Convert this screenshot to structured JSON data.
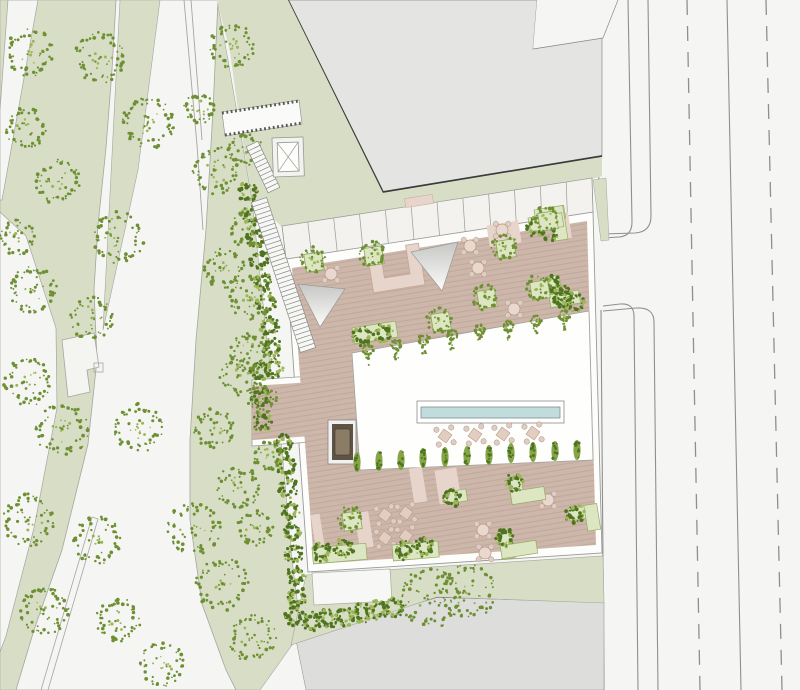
{
  "meta": {
    "title": "architectural-site-plan",
    "width": 800,
    "height": 690
  },
  "colors": {
    "bg": "#f5f5f3",
    "park_green": "#d7dec5",
    "path_stroke": "#a5a5a1",
    "tree_dark": "#5f8125",
    "tree_mid": "#6e9033",
    "tree_light": "#9cb657",
    "hedge_dark": "#4f7321",
    "hedge_light": "#9cb657",
    "building_fill": "#e4e4e2",
    "building_stroke": "#8a8a86",
    "building_dark_edge": "#3b3b39",
    "south_building_fill": "#dddddb",
    "south_building_edge": "#55534f",
    "road_line": "#8f8f8d",
    "site_border": "#9a9a96",
    "deck": "#cdb7aa",
    "deck_stripe": "#c1a99c",
    "parking_fill": "#f3f2ef",
    "courtyard_fill": "#fefefd",
    "white_patch": "#f7f7f5",
    "pink": "#e7d5cc",
    "pink_stroke": "#c5a795",
    "table_fill": "#ead8cf",
    "chair_fill": "#dfccc2",
    "chair_stroke": "#b59a89",
    "planter_green": "#dde6c2",
    "planter_stroke": "#97aa62",
    "pool_blue": "#c2dcde",
    "pool_stroke": "#7e8f91",
    "spa_dark": "#5d5446",
    "spa_mid": "#8b7d65",
    "tri_from": "#c6c6c4",
    "tri_to": "#fcfcfb",
    "stair_line": "#8a8a86",
    "hatch_dark": "#555553",
    "cypress_fill": "#85a546"
  },
  "park": {
    "base": [
      [
        0,
        0
      ],
      [
        217,
        0
      ],
      [
        228,
        60
      ],
      [
        252,
        200
      ],
      [
        268,
        350
      ],
      [
        282,
        450
      ],
      [
        292,
        560
      ],
      [
        300,
        622
      ],
      [
        292,
        645
      ],
      [
        260,
        690
      ],
      [
        0,
        690
      ]
    ],
    "path_a": [
      [
        8,
        0
      ],
      [
        38,
        0
      ],
      [
        2,
        200
      ],
      [
        0,
        200
      ],
      [
        0,
        110
      ]
    ],
    "path_b": [
      [
        0,
        212
      ],
      [
        26,
        236
      ],
      [
        56,
        328
      ],
      [
        57,
        408
      ],
      [
        34,
        528
      ],
      [
        6,
        636
      ],
      [
        0,
        652
      ]
    ],
    "path_big": [
      [
        116,
        0
      ],
      [
        218,
        0
      ],
      [
        213,
        110
      ],
      [
        206,
        230
      ],
      [
        196,
        340
      ],
      [
        190,
        440
      ],
      [
        190,
        520
      ],
      [
        202,
        604
      ],
      [
        226,
        670
      ],
      [
        236,
        690
      ],
      [
        16,
        690
      ],
      [
        34,
        630
      ],
      [
        62,
        550
      ],
      [
        88,
        444
      ],
      [
        97,
        360
      ],
      [
        94,
        290
      ],
      [
        98,
        225
      ],
      [
        106,
        148
      ],
      [
        112,
        70
      ]
    ],
    "green_island": [
      [
        120,
        0
      ],
      [
        160,
        0
      ],
      [
        138,
        170
      ],
      [
        103,
        330
      ]
    ],
    "wall_lines": [
      [
        [
          184,
          0
        ],
        [
          197,
          145
        ],
        [
          203,
          230
        ]
      ],
      [
        [
          191,
          0
        ],
        [
          202,
          140
        ]
      ]
    ],
    "ramp_wall": [
      [
        92,
        517
      ],
      [
        98,
        519
      ],
      [
        48,
        690
      ],
      [
        41,
        690
      ]
    ],
    "kiosk": [
      [
        62,
        340
      ],
      [
        94,
        333
      ],
      [
        99,
        367
      ],
      [
        87,
        370
      ],
      [
        90,
        392
      ],
      [
        68,
        397
      ]
    ],
    "kiosk_square": [
      94,
      363,
      9,
      9
    ],
    "trees": [
      [
        30,
        52,
        24
      ],
      [
        100,
        57,
        26
      ],
      [
        232,
        46,
        22
      ],
      [
        26,
        128,
        20
      ],
      [
        148,
        122,
        27
      ],
      [
        58,
        182,
        22
      ],
      [
        216,
        170,
        24
      ],
      [
        200,
        108,
        16
      ],
      [
        246,
        150,
        17
      ],
      [
        18,
        238,
        18
      ],
      [
        118,
        238,
        26
      ],
      [
        34,
        290,
        24
      ],
      [
        92,
        318,
        22
      ],
      [
        252,
        298,
        22
      ],
      [
        224,
        268,
        20
      ],
      [
        250,
        228,
        20
      ],
      [
        28,
        382,
        24
      ],
      [
        250,
        352,
        20
      ],
      [
        262,
        398,
        15
      ],
      [
        62,
        430,
        26
      ],
      [
        138,
        428,
        24
      ],
      [
        214,
        428,
        20
      ],
      [
        240,
        375,
        20
      ],
      [
        268,
        455,
        15
      ],
      [
        28,
        520,
        26
      ],
      [
        98,
        540,
        24
      ],
      [
        194,
        528,
        26
      ],
      [
        238,
        488,
        22
      ],
      [
        255,
        528,
        18
      ],
      [
        222,
        584,
        26
      ],
      [
        44,
        610,
        24
      ],
      [
        118,
        620,
        22
      ],
      [
        252,
        638,
        24
      ],
      [
        162,
        664,
        22
      ],
      [
        430,
        598,
        30
      ],
      [
        468,
        592,
        27
      ]
    ]
  },
  "buildings": {
    "north_body": [
      [
        288,
        0
      ],
      [
        537,
        0
      ],
      [
        533,
        49
      ],
      [
        602,
        38
      ],
      [
        602,
        156
      ],
      [
        383,
        192
      ]
    ],
    "north_dark_edge": [
      [
        288,
        0
      ],
      [
        383,
        192
      ],
      [
        602,
        156
      ]
    ],
    "north_wedge": [
      [
        537,
        0
      ],
      [
        624,
        0
      ],
      [
        603,
        38
      ],
      [
        533,
        49
      ]
    ],
    "north_wedge_line": [
      [
        603,
        38
      ],
      [
        618,
        0
      ]
    ],
    "south_body": [
      [
        296,
        640
      ],
      [
        437,
        597
      ],
      [
        604,
        602
      ],
      [
        604,
        690
      ],
      [
        306,
        690
      ]
    ],
    "south_dark_edge": [
      [
        296,
        640
      ],
      [
        437,
        597
      ],
      [
        604,
        602
      ]
    ]
  },
  "road": {
    "solid_paths": [
      "M592,0 C596,90 599,170 600,232",
      "M601,310 L604,690",
      "M628,0 C630,80 631,160 632,222 Q632,236 619,237 L603,238",
      "M603,306 L620,304 Q634,303 634,316 L638,690",
      "M648,0 C649,70 650,150 651,216 Q651,232 635,233 L603,234",
      "M603,311 L636,308 Q654,307 654,322 L658,690",
      "M727,0 L741,690"
    ],
    "dashed_paths": [
      "M687,0 L700,690",
      "M766,0 L782,690"
    ],
    "dash_pattern": "15 11"
  },
  "site": {
    "green_north": [
      [
        217,
        0
      ],
      [
        288,
        0
      ],
      [
        383,
        193
      ],
      [
        602,
        157
      ],
      [
        602,
        176
      ],
      [
        592,
        179
      ],
      [
        282,
        227
      ],
      [
        252,
        198
      ],
      [
        238,
        110
      ],
      [
        230,
        52
      ]
    ],
    "green_east": [
      [
        593,
        180
      ],
      [
        606,
        178
      ],
      [
        609,
        240
      ],
      [
        601,
        241
      ]
    ],
    "green_south": [
      [
        306,
        575
      ],
      [
        603,
        556
      ],
      [
        604,
        603
      ],
      [
        437,
        597
      ],
      [
        291,
        645
      ]
    ],
    "outer": [
      [
        286,
        259
      ],
      [
        593,
        212
      ],
      [
        602,
        553
      ],
      [
        308,
        572
      ]
    ],
    "deck": [
      [
        292,
        268
      ],
      [
        587,
        221
      ],
      [
        596,
        545
      ],
      [
        314,
        564
      ]
    ],
    "corridor_outer": [
      [
        252,
        380
      ],
      [
        312,
        376
      ],
      [
        312,
        442
      ],
      [
        252,
        446
      ]
    ],
    "corridor_deck": [
      [
        252,
        386
      ],
      [
        312,
        382
      ],
      [
        312,
        436
      ],
      [
        252,
        440
      ]
    ],
    "parking": {
      "top": [
        [
          282,
          226
        ],
        [
          592,
          178
        ]
      ],
      "bottom": [
        [
          286,
          259
        ],
        [
          593,
          212
        ]
      ],
      "dividers": 12,
      "notch": {
        "x": 419,
        "y": 201,
        "w": 28,
        "h": 9,
        "rot": -9
      }
    },
    "courtyard": [
      [
        352,
        353
      ],
      [
        589,
        311
      ],
      [
        593,
        460
      ],
      [
        360,
        470
      ]
    ],
    "pool": {
      "outer": [
        417,
        401,
        147,
        22
      ],
      "inner": [
        421,
        407,
        139,
        11
      ]
    },
    "white_patch": [
      [
        312,
        573
      ],
      [
        390,
        569
      ],
      [
        392,
        601
      ],
      [
        314,
        605
      ]
    ],
    "spa": {
      "outer": [
        328,
        420,
        28,
        44
      ],
      "dark": [
        332,
        424,
        21,
        36
      ],
      "inner": [
        335,
        429,
        15,
        26
      ]
    },
    "u_planter": {
      "cx": 396,
      "cy": 268,
      "rot": -9,
      "path": "M-26,-21 L-13,-21 L-13,8 L13,8 L13,-21 L26,-21 L26,21 L-26,21 Z"
    },
    "triangles": [
      [
        [
          298,
          284
        ],
        [
          345,
          289
        ],
        [
          320,
          327
        ]
      ],
      [
        [
          411,
          252
        ],
        [
          458,
          242
        ],
        [
          442,
          291
        ]
      ]
    ],
    "pink_patches": [
      [
        504,
        234,
        32,
        22,
        -9
      ],
      [
        563,
        226,
        14,
        26,
        -9
      ],
      [
        418,
        485,
        13,
        35,
        -9
      ],
      [
        448,
        486,
        22,
        34,
        -9
      ],
      [
        364,
        530,
        14,
        36,
        -9
      ],
      [
        318,
        533,
        9,
        38,
        -9
      ]
    ]
  },
  "furniture": {
    "round_tables": [
      [
        331,
        274
      ],
      [
        470,
        246
      ],
      [
        478,
        268
      ],
      [
        502,
        230
      ],
      [
        514,
        309
      ],
      [
        548,
        500
      ],
      [
        483,
        530
      ],
      [
        485,
        553
      ]
    ],
    "square_tables": [
      [
        445,
        436
      ],
      [
        475,
        435
      ],
      [
        503,
        434
      ],
      [
        533,
        433
      ],
      [
        385,
        515
      ],
      [
        406,
        513
      ],
      [
        385,
        538
      ],
      [
        406,
        536
      ]
    ]
  },
  "planting": {
    "planter_trees": [
      [
        314,
        262
      ],
      [
        374,
        256
      ],
      [
        506,
        249
      ],
      [
        548,
        221
      ],
      [
        487,
        299
      ],
      [
        441,
        322
      ],
      [
        540,
        290
      ],
      [
        352,
        521
      ]
    ],
    "l_planters": [
      {
        "rects": [
          [
            534,
            210,
            30,
            13
          ],
          [
            550,
            210,
            13,
            34
          ]
        ],
        "rot": -9,
        "bushes": []
      },
      {
        "rects": [
          [
            546,
            277,
            13,
            30
          ],
          [
            546,
            295,
            30,
            13
          ]
        ],
        "rot": -9,
        "bushes": [
          [
            552,
            284
          ],
          [
            564,
            300
          ]
        ]
      },
      {
        "rects": [
          [
            508,
            478,
            13,
            26
          ],
          [
            508,
            492,
            34,
            13
          ]
        ],
        "rot": -9,
        "bushes": [
          [
            514,
            483
          ]
        ]
      },
      {
        "rects": [
          [
            498,
            532,
            13,
            28
          ],
          [
            498,
            546,
            36,
            13
          ]
        ],
        "rot": -9,
        "bushes": [
          [
            505,
            538
          ]
        ]
      },
      {
        "rects": [
          [
            568,
            508,
            28,
            13
          ],
          [
            584,
            508,
            13,
            26
          ]
        ],
        "rot": -9,
        "bushes": [
          [
            575,
            514
          ]
        ]
      },
      {
        "rects": [
          [
            446,
            492,
            20,
            12
          ]
        ],
        "rot": -9,
        "bushes": [
          [
            452,
            497
          ]
        ]
      },
      {
        "rects": [
          [
            528,
            218,
            34,
            14
          ]
        ],
        "rot": -9,
        "bushes": [
          [
            536,
            227
          ],
          [
            549,
            232
          ]
        ]
      }
    ],
    "strip_planters": [
      {
        "rect": [
          312,
          548,
          54,
          16
        ],
        "rot": -5,
        "bushes": [
          [
            322,
            552
          ],
          [
            344,
            548
          ]
        ]
      },
      {
        "rect": [
          392,
          545,
          46,
          16
        ],
        "rot": -5,
        "bushes": [
          [
            404,
            550
          ],
          [
            424,
            547
          ]
        ]
      },
      {
        "rect": [
          352,
          328,
          44,
          16
        ],
        "rot": -9,
        "bushes": [
          [
            362,
            336
          ],
          [
            383,
            333
          ]
        ]
      }
    ],
    "loose_bushes": [
      [
        574,
        303
      ],
      [
        561,
        295
      ],
      [
        260,
        372
      ],
      [
        261,
        398
      ],
      [
        262,
        422
      ]
    ],
    "cypresses": [
      [
        357,
        462
      ],
      [
        379,
        461
      ],
      [
        401,
        460
      ],
      [
        423,
        458
      ],
      [
        445,
        457
      ],
      [
        467,
        456
      ],
      [
        489,
        455
      ],
      [
        511,
        453
      ],
      [
        533,
        452
      ],
      [
        555,
        451
      ],
      [
        577,
        450
      ]
    ],
    "poplars": [
      [
        368,
        350
      ],
      [
        396,
        345
      ],
      [
        424,
        340
      ],
      [
        452,
        335
      ],
      [
        480,
        330
      ],
      [
        508,
        326
      ],
      [
        536,
        321
      ],
      [
        564,
        316
      ]
    ],
    "hedge": [
      [
        248,
        192
      ],
      [
        252,
        215
      ],
      [
        256,
        238
      ],
      [
        260,
        260
      ],
      [
        263,
        282
      ],
      [
        266,
        304
      ],
      [
        269,
        326
      ],
      [
        272,
        348
      ],
      [
        274,
        368
      ],
      [
        283,
        444
      ],
      [
        286,
        466
      ],
      [
        288,
        488
      ],
      [
        290,
        510
      ],
      [
        292,
        532
      ],
      [
        294,
        554
      ],
      [
        296,
        576
      ],
      [
        297,
        597
      ],
      [
        295,
        616
      ],
      [
        311,
        622
      ],
      [
        328,
        619
      ],
      [
        345,
        616
      ],
      [
        362,
        613
      ],
      [
        379,
        610
      ],
      [
        394,
        608
      ]
    ]
  },
  "circulation": {
    "stairs": [
      {
        "x1": 252,
        "y1": 144,
        "x2": 274,
        "y2": 190,
        "w": 13
      },
      {
        "x1": 259,
        "y1": 200,
        "x2": 308,
        "y2": 350,
        "w": 16
      }
    ],
    "bridge": [
      [
        222,
        112
      ],
      [
        299,
        100
      ],
      [
        302,
        124
      ],
      [
        225,
        136
      ]
    ],
    "bridge_hatch_edges": [
      [
        [
          222,
          113
        ],
        [
          299,
          101
        ]
      ],
      [
        [
          225,
          135
        ],
        [
          302,
          123
        ]
      ]
    ],
    "elevator": {
      "outer": [
        272,
        138,
        31,
        39
      ],
      "inner": [
        277,
        143,
        21,
        29
      ]
    }
  }
}
